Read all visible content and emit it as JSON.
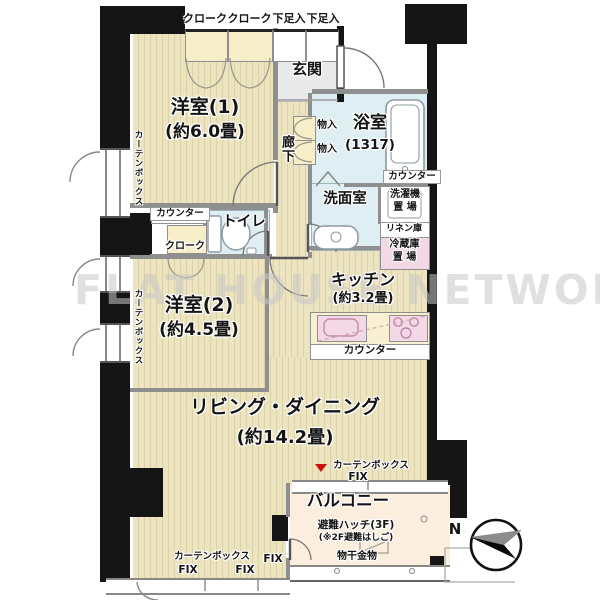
{
  "watermark": "FLAT HOUSE NETWORK",
  "compass": {
    "north_label": "N"
  },
  "rooms": {
    "western1": {
      "name": "洋室(1)",
      "size": "(約6.0畳)"
    },
    "western2": {
      "name": "洋室(2)",
      "size": "(約4.5畳)"
    },
    "living_dining": {
      "name": "リビング・ダイニング",
      "size": "(約14.2畳)"
    },
    "kitchen": {
      "name": "キッチン",
      "size": "(約3.2畳)"
    },
    "bathroom": {
      "name": "浴室",
      "size": "(1317)"
    },
    "washroom": {
      "name": "洗面室"
    },
    "toilet": {
      "name": "トイレ"
    },
    "entrance": {
      "name": "玄関"
    },
    "corridor": {
      "name": "廊下"
    },
    "balcony": {
      "name": "バルコニー"
    }
  },
  "storage": {
    "cloak1": "クローク",
    "cloak2": "クローク",
    "shoe1": "下足入",
    "shoe2": "下足入",
    "futon1": "物入",
    "futon2": "物入",
    "counter_bath": "カウンター",
    "washer": "洗濯機\n置 場",
    "linen": "リネン庫",
    "fridge": "冷蔵庫\n置 場",
    "counter_toilet": "カウンター",
    "cloak3": "クローク",
    "counter_kitchen": "カウンター"
  },
  "curtain_boxes": {
    "left1": "カーテンボックス",
    "left2": "カーテンボックス",
    "balcony": "カーテンボックス",
    "bottom": "カーテンボックス"
  },
  "windows": {
    "fix1": "FIX",
    "fix2": "FIX",
    "fix3": "FIX",
    "fix4": "FIX"
  },
  "balcony_items": {
    "hatch": "避難ハッチ(3F)",
    "hatch_note": "(※2F避難はしご)",
    "laundry_pole": "物干金物"
  },
  "colors": {
    "wall": "#151515",
    "partition": "#8f8f8f",
    "flooring": "#ece3c1",
    "flooring_stripe": "#dcd2a6",
    "wet_area": "#dfeef3",
    "entrance_floor": "#e9e9e9",
    "closet": "#f7edc8",
    "pink": "#f3d8e5",
    "balcony": "#fbeede",
    "marker_red": "#cc1111",
    "watermark": "#c8c8c8"
  }
}
